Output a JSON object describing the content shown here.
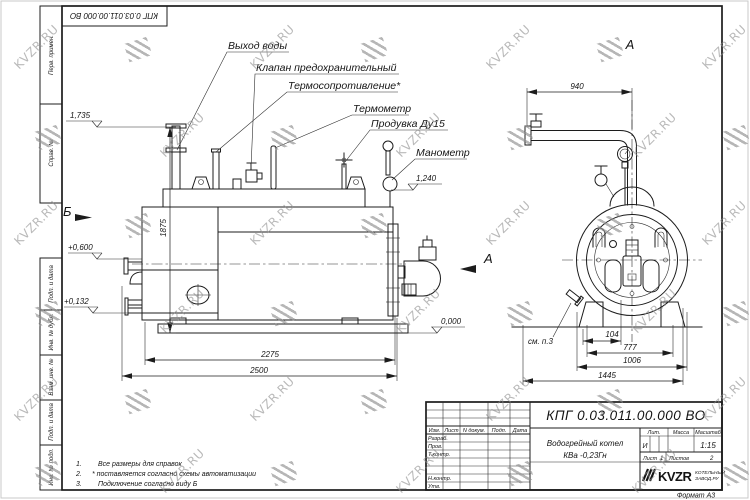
{
  "meta": {
    "colors": {
      "line": "#1c1c1c",
      "watermark": "#8f8f8f",
      "paper": "#ffffff"
    }
  },
  "watermark": {
    "text": "KVZR.RU"
  },
  "frame": {
    "designation_top": "КПГ 0.03.011.00.000  ВО",
    "strips": {
      "perv_primen": "Перв. примен.",
      "sprav_no": "Справ. №",
      "podp_data_1": "Подп. и дата",
      "inv_dubl": "Инв. № дубл.",
      "vzam_inv": "Взам. инв. №",
      "podp_data_2": "Подп. и дата",
      "inv_podl": "Инв. № подл."
    },
    "format_label": "Формат А3"
  },
  "side_view": {
    "callouts": {
      "water_outlet": "Выход воды",
      "safety_valve": "Клапан предохранительный",
      "thermal_resistance": "Термосопротивление*",
      "thermometer": "Термометр",
      "blowdown": "Продувка Ду15",
      "manometer": "Манометр"
    },
    "elevations": {
      "top": "1,735",
      "burner": "+0,600",
      "low": "+0,132",
      "gauge": "1,240",
      "zero": "0,000"
    },
    "dims": {
      "height": "1875",
      "body_length": "2275",
      "overall_length": "2500"
    },
    "view_arrow_a": "А",
    "view_arrow_b": "Б"
  },
  "front_view": {
    "label": "А",
    "note_ref": "см. п.3",
    "dims": {
      "pipe_span": "940",
      "d104": "104",
      "d777": "777",
      "d1006": "1006",
      "d1445": "1445"
    }
  },
  "notes": {
    "items": [
      {
        "num": "1.",
        "text": "Все размеры для справок"
      },
      {
        "num": "2.",
        "text": "* поставляется согласно схемы автоматизации"
      },
      {
        "num": "3.",
        "text": "Подключение согласно виду Б"
      }
    ]
  },
  "title_block": {
    "designation": "КПГ 0.03.011.00.000  ВО",
    "product_name_line1": "Водогрейный котел",
    "product_name_line2": "КВа -0,23Гн",
    "header_cols": {
      "izm": "Изм.",
      "list": "Лист",
      "n_dokum": "N докум.",
      "podp": "Подп.",
      "data": "Дата"
    },
    "signature_rows": {
      "razrab": "Разраб.",
      "prov": "Пров.",
      "tkontr": "Т.контр.",
      "nkontr": "Н.контр.",
      "utv": "Утв."
    },
    "lit_label": "Лит.",
    "lit_value": "И",
    "massa_label": "Масса",
    "masshtab_label": "Масштаб",
    "masshtab_value": "1:15",
    "list_label": "Лист",
    "list_value": "1",
    "listov_label": "Листов",
    "listov_value": "2",
    "logo_text": "KVZR",
    "logo_sub1": "КОТЕЛЬНЫЙ",
    "logo_sub2": "ЗАВОД.РУ"
  }
}
